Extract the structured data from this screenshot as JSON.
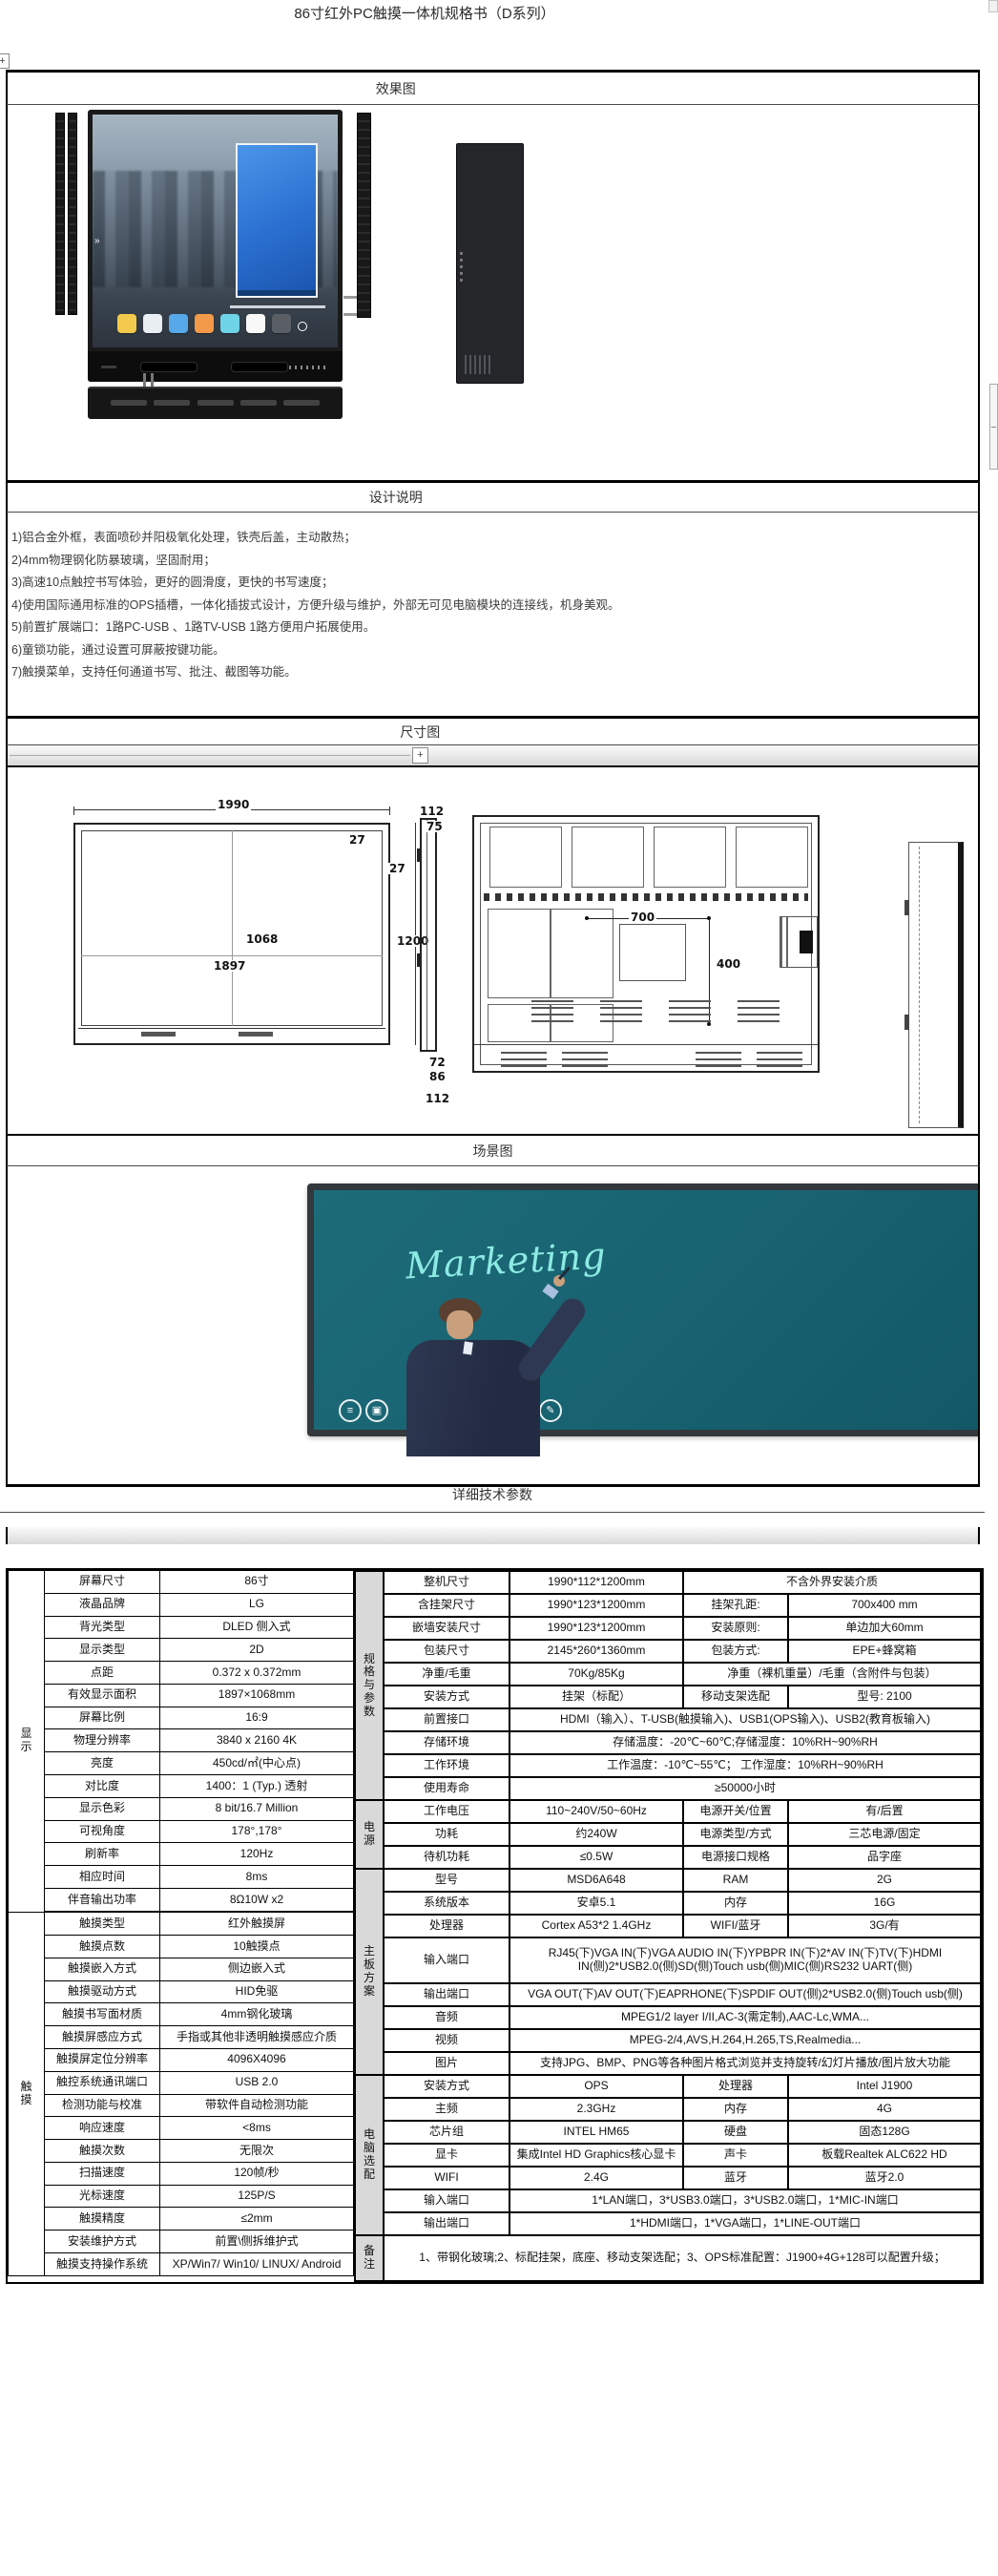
{
  "title": "86寸红外PC触摸一体机规格书（D系列）",
  "effect": {
    "header": "效果图",
    "screen_arrow": "»",
    "app_icon_colors": [
      "#f2c94c",
      "#e8eef2",
      "#56a8e8",
      "#f2994a",
      "#6fd3e8",
      "#f8f8f8",
      "#5a5f66"
    ]
  },
  "design": {
    "header": "设计说明",
    "lines": [
      "1)铝合金外框，表面喷砂并阳极氧化处理，铁壳后盖，主动散热；",
      "2)4mm物理钢化防暴玻璃，坚固耐用；",
      "3)高速10点触控书写体验，更好的圆滑度，更快的书写速度；",
      "4)使用国际通用标准的OPS插槽，一体化插拔式设计，方便升级与维护，外部无可见电脑模块的连接线，机身美观。",
      "5)前置扩展端口：1路PC-USB 、1路TV-USB 1路方便用户拓展使用。",
      "6)童锁功能，通过设置可屏蔽按键功能。",
      "7)触摸菜单，支持任何通道书写、批注、截图等功能。"
    ]
  },
  "dimension": {
    "header": "尺寸图",
    "expand_button": "+",
    "labels": {
      "front_width": "1990",
      "front_corner": "27",
      "front_frame": "27",
      "front_height": "1200",
      "active_h": "1068",
      "active_w": "1897",
      "side_top1": "112",
      "side_top2": "75",
      "side_bot1": "72",
      "side_bot2": "86",
      "side_bot3": "112",
      "vesa_w": "700",
      "vesa_h": "400"
    }
  },
  "scene": {
    "header": "场景图",
    "board_text": "Marketing",
    "toolbar_icons": [
      "≡",
      "▣",
      "↶",
      "✎"
    ]
  },
  "specs": {
    "header": "详细技术参数",
    "left_groups": [
      {
        "label": "显示",
        "rows": [
          [
            "屏幕尺寸",
            "86寸"
          ],
          [
            "液晶品牌",
            "LG"
          ],
          [
            "背光类型",
            "DLED 侧入式"
          ],
          [
            "显示类型",
            "2D"
          ],
          [
            "点距",
            "0.372 x 0.372mm"
          ],
          [
            "有效显示面积",
            "1897×1068mm"
          ],
          [
            "屏幕比例",
            "16:9"
          ],
          [
            "物理分辨率",
            "3840 x 2160  4K"
          ],
          [
            "亮度",
            "450cd/㎡(中心点)"
          ],
          [
            "对比度",
            "1400：1 (Typ.) 透射"
          ],
          [
            "显示色彩",
            "8 bit/16.7 Million"
          ],
          [
            "可视角度",
            "178°,178°"
          ],
          [
            "刷新率",
            "120Hz"
          ],
          [
            "相应时间",
            "8ms"
          ],
          [
            "伴音输出功率",
            "8Ω10W  x2"
          ]
        ]
      },
      {
        "label": "触摸",
        "rows": [
          [
            "触摸类型",
            "红外触摸屏"
          ],
          [
            "触摸点数",
            "10触摸点"
          ],
          [
            "触摸嵌入方式",
            "侧边嵌入式"
          ],
          [
            "触摸驱动方式",
            "HID免驱"
          ],
          [
            "触摸书写面材质",
            "4mm钢化玻璃"
          ],
          [
            "触摸屏感应方式",
            "手指或其他非透明触摸感应介质"
          ],
          [
            "触摸屏定位分辨率",
            "4096X4096"
          ],
          [
            "触控系统通讯端口",
            "USB 2.0"
          ],
          [
            "检测功能与校准",
            "带软件自动检测功能"
          ],
          [
            "响应速度",
            "<8ms"
          ],
          [
            "触摸次数",
            "无限次"
          ],
          [
            "扫描速度",
            "120帧/秒"
          ],
          [
            "光标速度",
            "125P/S"
          ],
          [
            "触摸精度",
            "≤2mm"
          ],
          [
            "安装维护方式",
            "前置\\侧拆维护式"
          ],
          [
            "触摸支持操作系统",
            "XP/Win7/ Win10/ LINUX/ Android"
          ]
        ]
      }
    ],
    "right_groups": [
      {
        "label": "规格与参数",
        "rows": [
          {
            "l": "整机尺寸",
            "c": [
              {
                "t": "1990*112*1200mm"
              },
              {
                "t": "不含外界安装介质",
                "s": 2
              }
            ]
          },
          {
            "l": "含挂架尺寸",
            "c": [
              {
                "t": "1990*123*1200mm"
              },
              {
                "t": "挂架孔距:",
                "a": "l"
              },
              {
                "t": "700x400 mm"
              }
            ]
          },
          {
            "l": "嵌墙安装尺寸",
            "c": [
              {
                "t": "1990*123*1200mm"
              },
              {
                "t": "安装原则:",
                "a": "l"
              },
              {
                "t": "单边加大60mm"
              }
            ]
          },
          {
            "l": "包装尺寸",
            "c": [
              {
                "t": "2145*260*1360mm"
              },
              {
                "t": "包装方式:",
                "a": "l"
              },
              {
                "t": "EPE+蜂窝箱"
              }
            ]
          },
          {
            "l": "净重/毛重",
            "c": [
              {
                "t": "70Kg/85Kg"
              },
              {
                "t": "净重（裸机重量）/毛重（含附件与包装）",
                "s": 2
              }
            ]
          },
          {
            "l": "安装方式",
            "c": [
              {
                "t": "挂架（标配）"
              },
              {
                "t": "移动支架选配",
                "a": "l"
              },
              {
                "t": "型号: 2100"
              }
            ]
          },
          {
            "l": "前置接口",
            "c": [
              {
                "t": "HDMI（输入）、T-USB(触摸输入)、USB1(OPS输入)、USB2(教育板输入)",
                "s": 3
              }
            ]
          },
          {
            "l": "存储环境",
            "c": [
              {
                "t": "存储温度：-20℃~60℃;存储湿度：10%RH~90%RH",
                "s": 3
              }
            ]
          },
          {
            "l": "工作环境",
            "c": [
              {
                "t": "工作温度：-10℃~55℃； 工作湿度：10%RH~90%RH",
                "s": 3
              }
            ]
          },
          {
            "l": "使用寿命",
            "c": [
              {
                "t": "≥50000小时",
                "s": 3
              }
            ]
          }
        ]
      },
      {
        "label": "电源",
        "rows": [
          {
            "l": "工作电压",
            "c": [
              {
                "t": "110~240V/50~60Hz"
              },
              {
                "t": "电源开关/位置",
                "a": "l"
              },
              {
                "t": "有/后置"
              }
            ]
          },
          {
            "l": "功耗",
            "c": [
              {
                "t": "约240W"
              },
              {
                "t": "电源类型/方式",
                "a": "l"
              },
              {
                "t": "三芯电源/固定"
              }
            ]
          },
          {
            "l": "待机功耗",
            "c": [
              {
                "t": "≤0.5W"
              },
              {
                "t": "电源接口规格",
                "a": "l"
              },
              {
                "t": "品字座"
              }
            ]
          }
        ]
      },
      {
        "label": "主板方案",
        "rows": [
          {
            "l": "型号",
            "c": [
              {
                "t": "MSD6A648"
              },
              {
                "t": "RAM",
                "a": "l"
              },
              {
                "t": "2G"
              }
            ]
          },
          {
            "l": "系统版本",
            "c": [
              {
                "t": "安卓5.1"
              },
              {
                "t": "内存",
                "a": "l"
              },
              {
                "t": "16G"
              }
            ]
          },
          {
            "l": "处理器",
            "c": [
              {
                "t": "Cortex A53*2 1.4GHz"
              },
              {
                "t": "WIFI/蓝牙",
                "a": "l"
              },
              {
                "t": "3G/有"
              }
            ]
          },
          {
            "l": "输入端口",
            "h": 2,
            "c": [
              {
                "t": "RJ45(下)VGA IN(下)VGA AUDIO IN(下)YPBPR IN(下)2*AV IN(下)TV(下)HDMI IN(侧)2*USB2.0(侧)SD(侧)Touch usb(侧)MIC(侧)RS232 UART(侧)",
                "s": 3
              }
            ]
          },
          {
            "l": "输出端口",
            "c": [
              {
                "t": "VGA OUT(下)AV OUT(下)EAPRHONE(下)SPDIF OUT(侧)2*USB2.0(侧)Touch usb(侧)",
                "s": 3
              }
            ]
          },
          {
            "l": "音频",
            "c": [
              {
                "t": "MPEG1/2 layer I/II,AC-3(需定制),AAC-Lc,WMA...",
                "s": 3
              }
            ]
          },
          {
            "l": "视频",
            "c": [
              {
                "t": "MPEG-2/4,AVS,H.264,H.265,TS,Realmedia...",
                "s": 3
              }
            ]
          },
          {
            "l": "图片",
            "c": [
              {
                "t": "支持JPG、BMP、PNG等各种图片格式浏览并支持旋转/幻灯片播放/图片放大功能",
                "s": 3
              }
            ]
          }
        ]
      },
      {
        "label": "电脑选配",
        "rows": [
          {
            "l": "安装方式",
            "c": [
              {
                "t": "OPS"
              },
              {
                "t": "处理器",
                "a": "l"
              },
              {
                "t": "Intel J1900"
              }
            ]
          },
          {
            "l": "主频",
            "c": [
              {
                "t": "2.3GHz"
              },
              {
                "t": "内存",
                "a": "l"
              },
              {
                "t": "4G"
              }
            ]
          },
          {
            "l": "芯片组",
            "c": [
              {
                "t": "INTEL HM65"
              },
              {
                "t": "硬盘",
                "a": "l"
              },
              {
                "t": "固态128G"
              }
            ]
          },
          {
            "l": "显卡",
            "c": [
              {
                "t": "集成Intel HD Graphics核心显卡"
              },
              {
                "t": "声卡",
                "a": "l"
              },
              {
                "t": "板载Realtek ALC622 HD"
              }
            ]
          },
          {
            "l": "WIFI",
            "c": [
              {
                "t": "2.4G"
              },
              {
                "t": "蓝牙",
                "a": "l"
              },
              {
                "t": "蓝牙2.0"
              }
            ]
          },
          {
            "l": "输入端口",
            "c": [
              {
                "t": "1*LAN端口，3*USB3.0端口，3*USB2.0端口，1*MIC-IN端口",
                "s": 3
              }
            ]
          },
          {
            "l": "输出端口",
            "c": [
              {
                "t": "1*HDMI端口，1*VGA端口，1*LINE-OUT端口",
                "s": 3
              }
            ]
          }
        ]
      },
      {
        "label": "备注",
        "rows": [
          {
            "h": 2,
            "c": [
              {
                "t": "1、带钢化玻璃;2、标配挂架，底座、移动支架选配；3、OPS标准配置：J1900+4G+128可以配置升级；",
                "s": 4
              }
            ]
          }
        ]
      }
    ]
  }
}
